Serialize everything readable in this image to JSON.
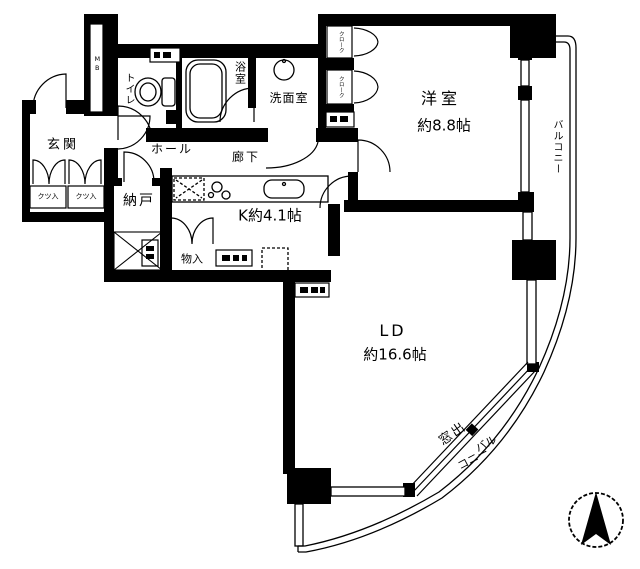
{
  "colors": {
    "ink": "#000000",
    "paper": "#ffffff"
  },
  "rooms": {
    "entrance": "玄関",
    "toilet": "トイレ",
    "bath": "浴室",
    "washroom": "洗面室",
    "hall": "ホール",
    "corridor": "廊下",
    "storage_room": "納戸",
    "kitchen": "K約4.1帖",
    "closet": "物入",
    "western_room": "洋室",
    "western_room_size": "約8.8帖",
    "living_dining": "LD",
    "living_dining_size": "約16.6帖"
  },
  "storage": {
    "shoe_box_1": "クツ入",
    "shoe_box_2": "クツ入",
    "cloak_1": "クローク",
    "cloak_2": "クローク",
    "meter_box": "MB"
  },
  "balcony": {
    "side": "バルコニー",
    "bottom_line_1": "バル",
    "bottom_line_2": "コニー",
    "bay_window": "窓出"
  }
}
